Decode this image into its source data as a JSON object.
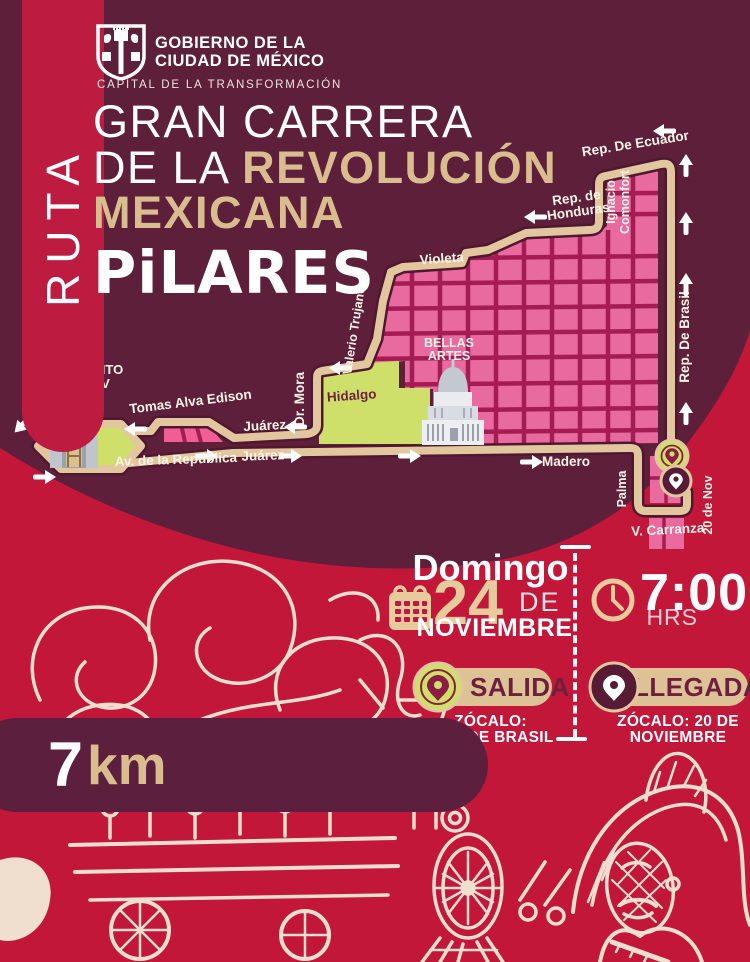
{
  "government": {
    "line1": "GOBIERNO DE LA",
    "line2": "CIUDAD DE MÉXICO",
    "tagline": "CAPITAL DE LA TRANSFORMACIÓN"
  },
  "ribbon": {
    "label": "RUTA"
  },
  "title": {
    "line1": "GRAN CARRERA",
    "line2_prefix": "DE LA ",
    "line2_accent": "REVOLUCIÓN",
    "line3": "MEXICANA",
    "brand": "PiLARES"
  },
  "map": {
    "labels": {
      "ecuador": "Rep. De Ecuador",
      "honduras_1": "Rep. de",
      "honduras_2": "Honduras",
      "comonfort_1": "Ignacio",
      "comonfort_2": "Comonfort",
      "violeta": "Violeta",
      "trujano": "Valerio Trujano",
      "brasil": "Rep. De Brasil",
      "hidalgo": "Hidalgo",
      "dr_mora": "Dr. Mora",
      "bellas_artes_1": "BELLAS",
      "bellas_artes_2": "ARTES",
      "monumento_1": "MONUMENTO",
      "monumento_2": "A LA REV",
      "tomas": "Tomas Alva Edison",
      "juarez_west": "Juárez",
      "juarez_east": "Juárez",
      "av_republica": "Av. de la República",
      "madero": "Madero",
      "palma": "Palma",
      "carranza": "V. Carranza",
      "veinte_nov": "20 de Nov"
    }
  },
  "event": {
    "day": "Domingo",
    "date_number": "24",
    "date_connector": "DE",
    "month": "NOVIEMBRE",
    "time": "7:00",
    "time_unit": "HRS",
    "start": {
      "label": "SALIDA",
      "location_line1": "ZÓCALO:",
      "location_line2": "REP. DE BRASIL"
    },
    "finish": {
      "label": "LLEGADA",
      "location_line1": "ZÓCALO: 20 DE",
      "location_line2": "NOVIEMBRE"
    }
  },
  "distance": {
    "value": "7",
    "unit": "km"
  },
  "colors": {
    "maroon_bg": "#5e1f3a",
    "crimson_bg": "#c3173a",
    "route_tan": "#e2c79e",
    "map_pink": "#e86a9e",
    "map_grid": "#a31c53",
    "map_green": "#cfe06a",
    "text_tan": "#d9bd8e",
    "white": "#ffffff"
  }
}
